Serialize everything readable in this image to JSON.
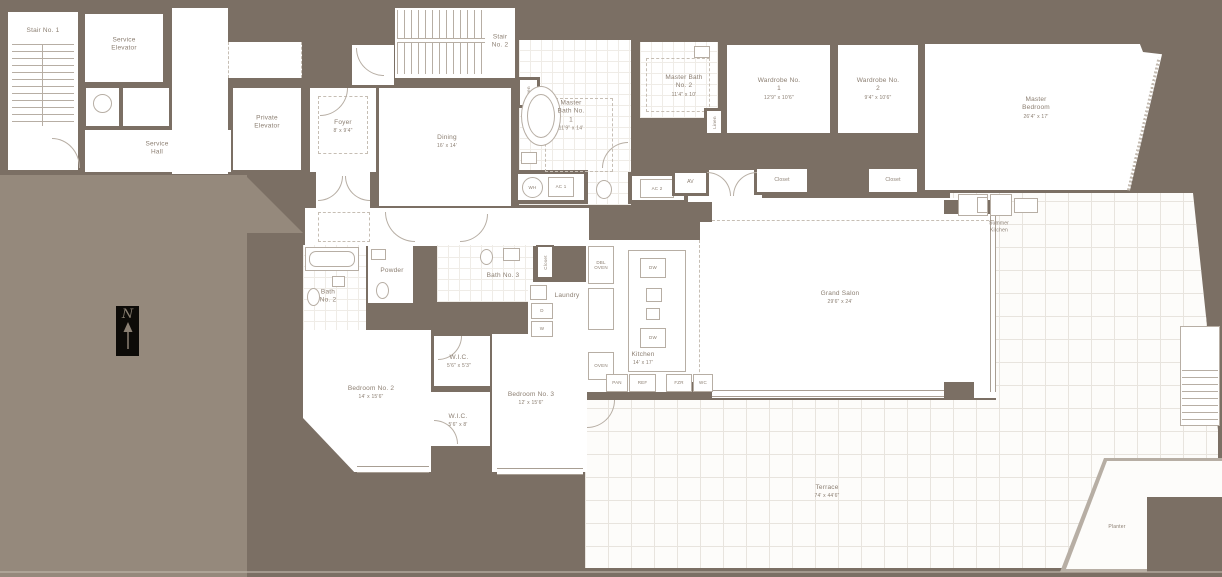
{
  "colors": {
    "wall": "#7b6f64",
    "light_mass": "#95897c",
    "room_fill": "#ffffff",
    "fixture_line": "#b7aea4",
    "text": "#8b7e71",
    "compass_bg": "#0d0b08"
  },
  "compass": {
    "label": "N"
  },
  "rooms": {
    "stair_1": {
      "name": "Stair No. 1"
    },
    "service_elevator": {
      "name": "Service Elevator"
    },
    "service_hall": {
      "name": "Service Hall"
    },
    "private_elevator": {
      "name": "Private Elevator"
    },
    "stair_2": {
      "name": "Stair No. 2"
    },
    "foyer": {
      "name": "Foyer",
      "dim": "8' x 9'4\""
    },
    "dining": {
      "name": "Dining",
      "dim": "16' x 14'"
    },
    "master_bath_1": {
      "name": "Master Bath No. 1",
      "dim": "11'9\" x 14'"
    },
    "master_bath_2": {
      "name": "Master Bath No. 2",
      "dim": "11'4\" x 10'"
    },
    "wardrobe_1": {
      "name": "Wardrobe No. 1",
      "dim": "12'9\" x 10'6\""
    },
    "wardrobe_2": {
      "name": "Wardrobe No. 2",
      "dim": "9'4\" x 10'6\""
    },
    "master_bedroom": {
      "name": "Master Bedroom",
      "dim": "26'4\" x 17'"
    },
    "grand_salon": {
      "name": "Grand Salon",
      "dim": "29'6\" x 24'"
    },
    "summer_kitchen": {
      "name": "Summer Kitchen"
    },
    "kitchen": {
      "name": "Kitchen",
      "dim": "14' x 17'"
    },
    "bath_2": {
      "name": "Bath No. 2"
    },
    "powder": {
      "name": "Powder"
    },
    "bath_3": {
      "name": "Bath No. 3"
    },
    "laundry": {
      "name": "Laundry"
    },
    "wic_1": {
      "name": "W.I.C.",
      "dim": "5'6\" x 5'3\""
    },
    "wic_2": {
      "name": "W.I.C.",
      "dim": "5'6\" x 8'"
    },
    "bedroom_2": {
      "name": "Bedroom No. 2",
      "dim": "14' x 15'6\""
    },
    "bedroom_3": {
      "name": "Bedroom No. 3",
      "dim": "12' x 15'6\""
    },
    "terrace": {
      "name": "Terrace",
      "dim": "74' x 44'6\""
    },
    "planter": {
      "name": "Planter"
    }
  },
  "fixtures": {
    "wh": "WH",
    "ac1": "AC 1",
    "ac2": "AC 2",
    "av": "AV",
    "closet_a": "Closet",
    "closet_b": "Closet",
    "closet_c": "Closet",
    "linen_a": "Linen",
    "linen_b": "Linen",
    "dryer": "D",
    "washer": "W",
    "dbl_oven": "DBL OVEN",
    "oven": "OVEN",
    "dw_1": "DW",
    "dw_2": "DW",
    "pan": "PAN",
    "ref": "REF",
    "fzr": "FZR",
    "wc": "WC"
  }
}
